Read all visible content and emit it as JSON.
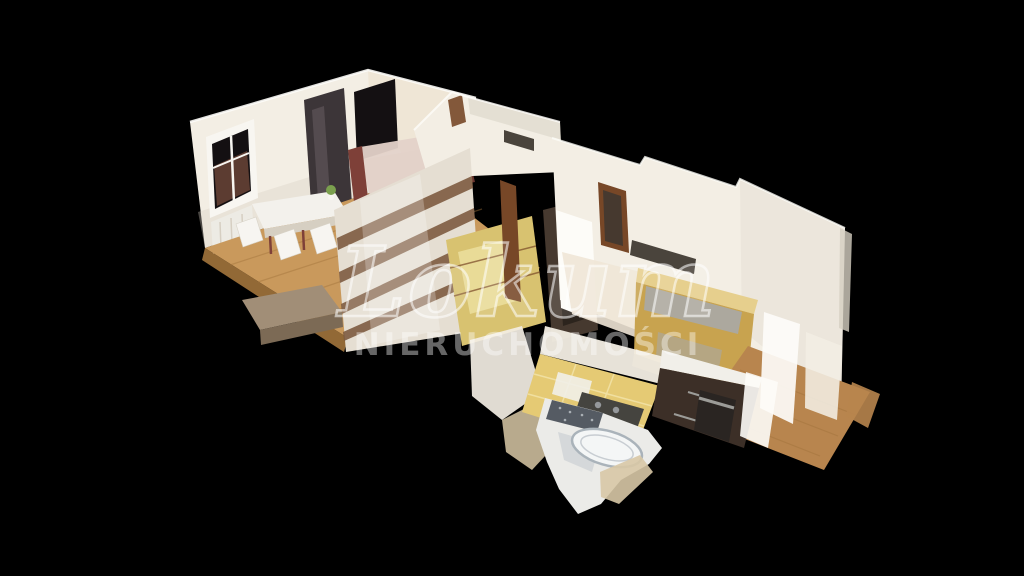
{
  "watermark": {
    "logo_text": "Lokum",
    "subtitle_text": "NIERUCHOMOŚCI"
  },
  "scene": {
    "description": "3D dollhouse cutaway scan of an apartment viewed from above at an angle, floating on a black background",
    "rooms": [
      "living-dining-room",
      "hallway-with-wardrobes",
      "bedroom",
      "kitchen",
      "bathroom"
    ],
    "objects": [
      "window",
      "curtains",
      "radiator",
      "mirror",
      "dining-table",
      "chairs",
      "plant",
      "sofa",
      "platform-step",
      "wardrobe-panels",
      "yellow-closet",
      "door-frames",
      "gold-furniture",
      "kitchen-cabinets",
      "oven",
      "gas-stove",
      "fridge",
      "tile-floor",
      "bathtub",
      "mosaic-tiles",
      "wood-floors"
    ]
  },
  "colors": {
    "background": "#000000",
    "wall_white": "#f3eee4",
    "wall_bright": "#fdfcf8",
    "wall_cream": "#efe6d6",
    "wall_shadow": "#d6cfc2",
    "floor_wood": "#c9995c",
    "floor_wood_dark": "#a2743c",
    "floor_wood_bedroom": "#b8854e",
    "platform_top": "#a18e77",
    "platform_side": "#7c6a55",
    "window_dark": "#141012",
    "window_view": "#6e473a",
    "mirror_dark": "#3c3538",
    "mirror_streak": "#6b6166",
    "curtain_white": "#f8f6f1",
    "radiator_white": "#edebe4",
    "table_white": "#f3f1ec",
    "chair_white": "#f7f5f1",
    "plant_green": "#7ba04e",
    "sofa_frame": "#7e4038",
    "sofa_cushion": "#e3d2c9",
    "wardrobe_panel": "#e5ded2",
    "wardrobe_band": "#7d5b40",
    "wardrobe_yellow": "#d8c270",
    "wardrobe_yellow_light": "#ecdf9e",
    "door_brown": "#774727",
    "passage_dark": "#46392f",
    "passage_inner": "#2c241d",
    "vent_dark": "#4a443c",
    "furniture_gold": "#c8a34f",
    "furniture_gold_light": "#e6cf8d",
    "furniture_gold_dark": "#6f5930",
    "furniture_steel": "#a9a9a6",
    "cabinet_dark": "#3c2f27",
    "counter_white": "#f1efe9",
    "oven_black": "#2a2522",
    "oven_steel": "#9c9c98",
    "tile_yellow": "#e5ca74",
    "tile_grout": "#f0dfa0",
    "stove_dark": "#45443f",
    "burner_gray": "#95989b",
    "bath_white": "#ebebe8",
    "bath_shadow": "#c6cbd0",
    "tub_fill": "#f4f6f6",
    "tub_stroke": "#aab3ba",
    "mosaic_dark": "#555b63",
    "mosaic_dot": "#cfd4d8",
    "fragment_beige": "#d8c8a6",
    "watermark_stroke": "rgba(255,255,255,0.55)",
    "watermark_fill": "rgba(255,255,255,0.40)",
    "watermark_faint": "rgba(255,255,255,0.12)"
  }
}
